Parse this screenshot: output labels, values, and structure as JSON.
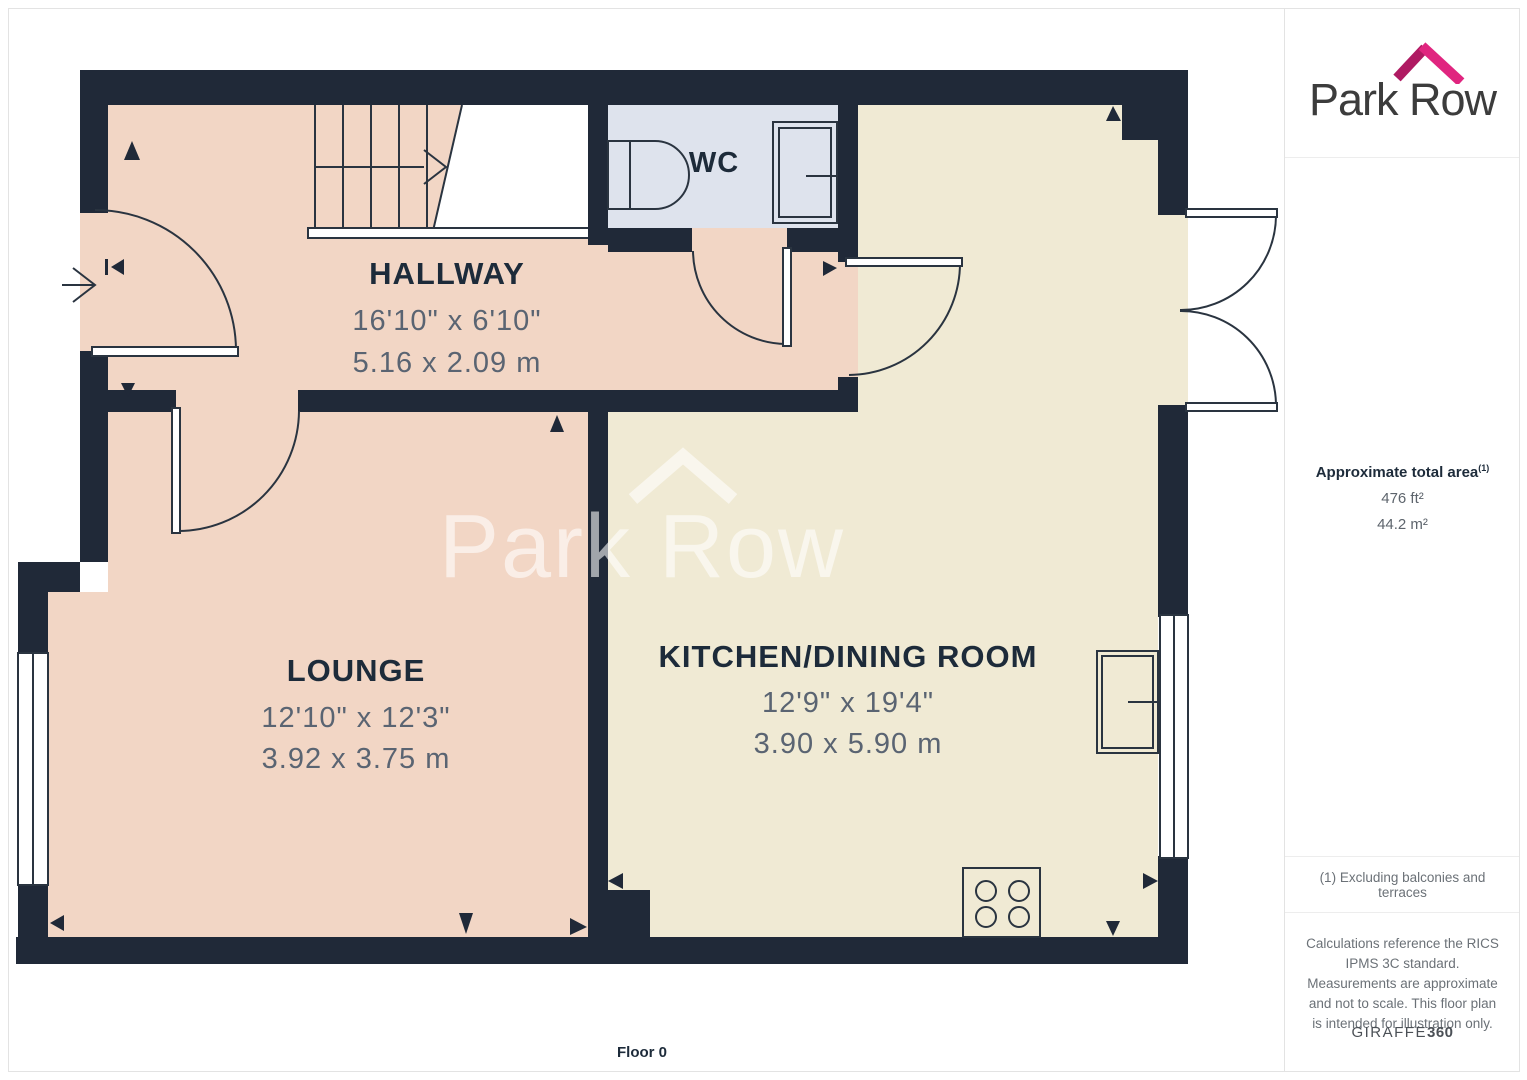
{
  "branding": {
    "logo_text": "Park Row",
    "watermark_text": "Park Row"
  },
  "sidebar": {
    "area_title": "Approximate total area",
    "area_note_ref": "(1)",
    "area_imperial": "476 ft²",
    "area_metric": "44.2 m²",
    "footnote": "(1) Excluding balconies and terraces",
    "disclaimer": "Calculations reference the RICS IPMS 3C standard. Measurements are approximate and not to scale. This floor plan is intended for illustration only.",
    "credit_name": "GIRAFFE",
    "credit_suffix": "360"
  },
  "floor_label": "Floor 0",
  "rooms": {
    "hallway": {
      "name": "HALLWAY",
      "imperial": "16'10\" x 6'10\"",
      "metric": "5.16 x 2.09 m"
    },
    "wc": {
      "name": "WC"
    },
    "lounge": {
      "name": "LOUNGE",
      "imperial": "12'10\" x 12'3\"",
      "metric": "3.92 x 3.75 m"
    },
    "kitchen": {
      "name": "KITCHEN/DINING ROOM",
      "imperial": "12'9\" x 19'4\"",
      "metric": "3.90 x 5.90 m"
    }
  },
  "colors": {
    "wall": "#202938",
    "floor_pink": "#F2D6C5",
    "floor_cream": "#F0EAD4",
    "floor_wc": "#DEE3ED",
    "line": "#2A3440",
    "label": "#1D2B3A",
    "dim": "#5A6472",
    "accent_pink": "#E0257F",
    "accent_dark": "#AF1A62",
    "watermark": "rgba(255,255,255,0.58)"
  }
}
